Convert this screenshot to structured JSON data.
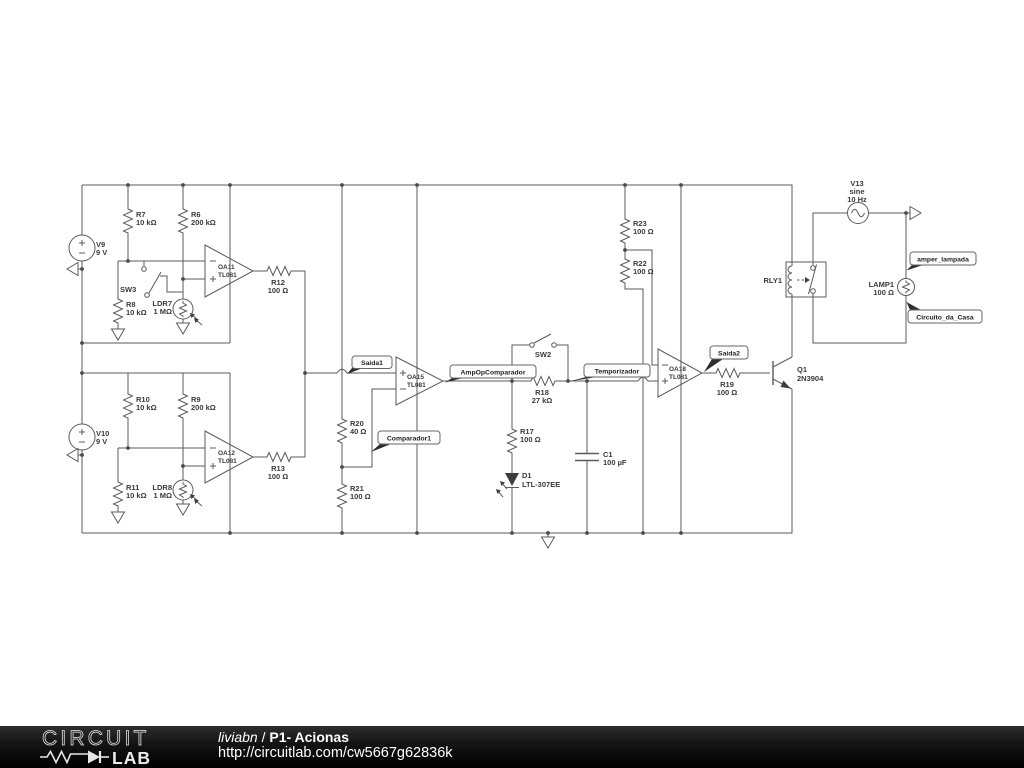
{
  "components": {
    "V9": {
      "name": "V9",
      "value": "9 V"
    },
    "V10": {
      "name": "V10",
      "value": "9 V"
    },
    "V13": {
      "name": "V13",
      "value": "sine",
      "freq": "10 Hz"
    },
    "R6": {
      "name": "R6",
      "value": "200 kΩ"
    },
    "R7": {
      "name": "R7",
      "value": "10 kΩ"
    },
    "R8": {
      "name": "R8",
      "value": "10 kΩ"
    },
    "R9": {
      "name": "R9",
      "value": "200 kΩ"
    },
    "R10": {
      "name": "R10",
      "value": "10 kΩ"
    },
    "R11": {
      "name": "R11",
      "value": "10 kΩ"
    },
    "R12": {
      "name": "R12",
      "value": "100 Ω"
    },
    "R13": {
      "name": "R13",
      "value": "100 Ω"
    },
    "R17": {
      "name": "R17",
      "value": "100 Ω"
    },
    "R18": {
      "name": "R18",
      "value": "27 kΩ"
    },
    "R19": {
      "name": "R19",
      "value": "100 Ω"
    },
    "R20": {
      "name": "R20",
      "value": "40 Ω"
    },
    "R21": {
      "name": "R21",
      "value": "100 Ω"
    },
    "R22": {
      "name": "R22",
      "value": "100 Ω"
    },
    "R23": {
      "name": "R23",
      "value": "100 Ω"
    },
    "LDR7": {
      "name": "LDR7",
      "value": "1 MΩ"
    },
    "LDR8": {
      "name": "LDR8",
      "value": "1 MΩ"
    },
    "OA11": {
      "name": "OA11",
      "value": "TL081"
    },
    "OA12": {
      "name": "OA12",
      "value": "TL081"
    },
    "OA15": {
      "name": "OA15",
      "value": "TL081"
    },
    "OA18": {
      "name": "OA18",
      "value": "TL081"
    },
    "SW2": {
      "name": "SW2"
    },
    "SW3": {
      "name": "SW3"
    },
    "C1": {
      "name": "C1",
      "value": "100 µF"
    },
    "D1": {
      "name": "D1",
      "value": "LTL-307EE"
    },
    "Q1": {
      "name": "Q1",
      "value": "2N3904"
    },
    "RLY1": {
      "name": "RLY1"
    },
    "LAMP1": {
      "name": "LAMP1",
      "value": "100 Ω"
    }
  },
  "flags": {
    "saida1": "Saida1",
    "ampop": "AmpOpComparador",
    "comparador1": "Comparador1",
    "temporizador": "Temporizador",
    "saida2": "Saida2",
    "amper_lampada": "amper_lampada",
    "circuito_da_casa": "Circuito_da_Casa"
  },
  "footer": {
    "logo_top": "CIRCUIT",
    "logo_bottom": "LAB",
    "author": "liviabn",
    "divider": "/",
    "title": "P1- Acionas",
    "url": "http://circuitlab.com/cw5667g62836k"
  },
  "colors": {
    "wire": "#5b5b5b",
    "schematic_text": "#3a3a3a",
    "footer_background": "#000000",
    "footer_text": "#ffffff",
    "canvas": "#ffffff"
  }
}
